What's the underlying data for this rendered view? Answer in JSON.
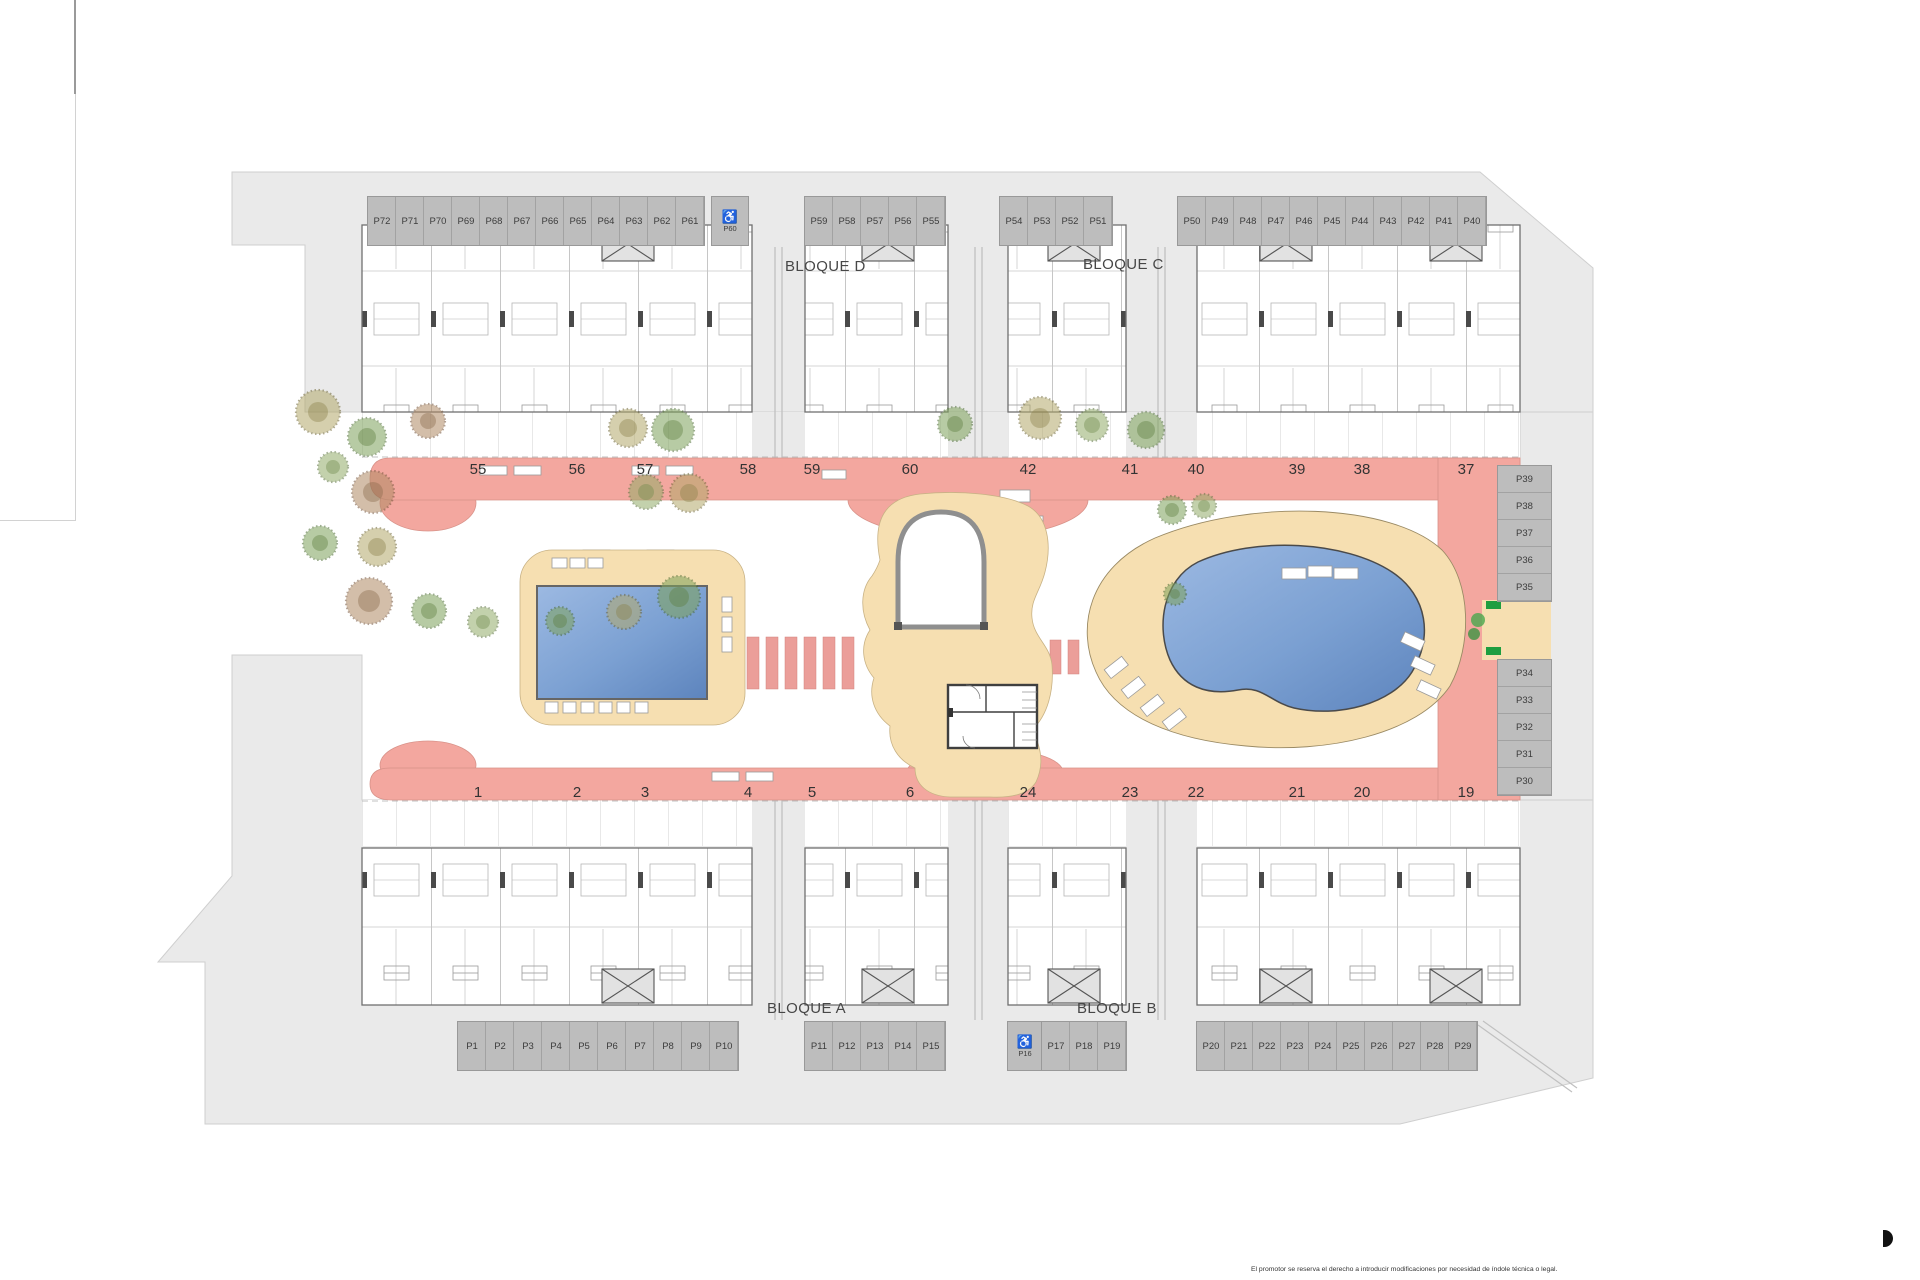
{
  "site_plan": {
    "blocks": {
      "d": "BLOQUE D",
      "c": "BLOQUE C",
      "a": "BLOQUE A",
      "b": "BLOQUE B"
    },
    "unit_rows": {
      "top_left": [
        "55",
        "56",
        "57",
        "58",
        "59",
        "60"
      ],
      "top_right": [
        "42",
        "41",
        "40",
        "39",
        "38",
        "37"
      ],
      "bottom_left": [
        "1",
        "2",
        "3",
        "4",
        "5",
        "6"
      ],
      "bottom_right": [
        "24",
        "23",
        "22",
        "21",
        "20",
        "19"
      ]
    },
    "parking": {
      "top_left": [
        "P72",
        "P71",
        "P70",
        "P69",
        "P68",
        "P67",
        "P66",
        "P65",
        "P64",
        "P63",
        "P62",
        "P61"
      ],
      "top_left_accessible": "P60",
      "top_mid_a": [
        "P59",
        "P58",
        "P57",
        "P56",
        "P55"
      ],
      "top_mid_b": [
        "P54",
        "P53",
        "P52",
        "P51"
      ],
      "top_right": [
        "P50",
        "P49",
        "P48",
        "P47",
        "P46",
        "P45",
        "P44",
        "P43",
        "P42",
        "P41",
        "P40"
      ],
      "right_upper": [
        "P39",
        "P38",
        "P37",
        "P36",
        "P35"
      ],
      "right_lower": [
        "P34",
        "P33",
        "P32",
        "P31",
        "P30"
      ],
      "bottom_a": [
        "P1",
        "P2",
        "P3",
        "P4",
        "P5",
        "P6",
        "P7",
        "P8",
        "P9",
        "P10"
      ],
      "bottom_b": [
        "P11",
        "P12",
        "P13",
        "P14",
        "P15"
      ],
      "bottom_accessible": "P16",
      "bottom_c": [
        "P17",
        "P18",
        "P19"
      ],
      "bottom_d": [
        "P20",
        "P21",
        "P22",
        "P23",
        "P24",
        "P25",
        "P26",
        "P27",
        "P28",
        "P29"
      ]
    },
    "accessible_icon": "♿",
    "disclaimer": "El promotor se reserva el derecho a introducir modificaciones por necesidad de índole técnica o legal.",
    "colors": {
      "walkway_salmon": "#f3a79f",
      "deck_tan": "#f6dfb1",
      "pool_blue": "#6f9ed6",
      "parcel_gray": "#eaeaea",
      "stall_gray": "#bdbdbd",
      "exit_sign_green": "#1e9e40"
    }
  }
}
